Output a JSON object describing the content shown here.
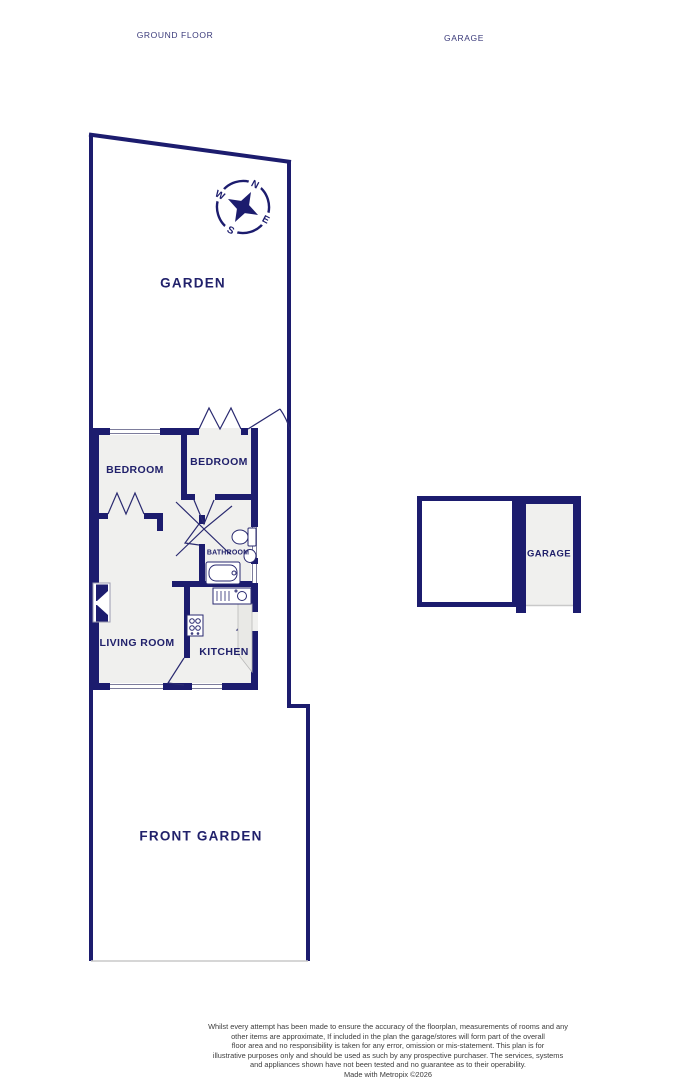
{
  "title": {
    "left": "GROUND FLOOR",
    "right": "GARAGE"
  },
  "rooms": {
    "garden": "GARDEN",
    "bedroom1": "BEDROOM",
    "bedroom2": "BEDROOM",
    "bathroom": "BATHROOM",
    "living_room": "LIVING ROOM",
    "kitchen": "KITCHEN",
    "front_garden": "FRONT GARDEN",
    "garage": "GARAGE"
  },
  "compass": {
    "north": "N",
    "east": "E",
    "south": "S",
    "west": "W"
  },
  "footer": {
    "lines": [
      "Whilst every attempt has been made to ensure the accuracy of the floorplan, measurements of rooms and any",
      "other items are approximate, If included in the plan the garage/stores will form part of the overall",
      "floor area and no responsibility is taken for any error, omission or mis-statement. This plan is for",
      "illustrative purposes only and should be used as such by any prospective purchaser. The services, systems",
      "and appliances shown have not been tested and no guarantee as to their operability.",
      "Made with Metropix ©2026"
    ]
  },
  "colors": {
    "wall": "#1c1c6e",
    "room_fill": "#f0f0ee",
    "window_line": "#7d7d9c",
    "open_boundary": "#c9c9c9",
    "counter_fill": "#e9e9e6",
    "disclaimer_text": "#3c3c3c"
  }
}
